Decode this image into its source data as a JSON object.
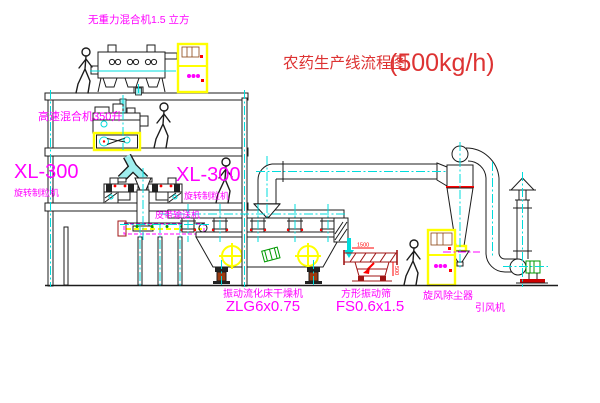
{
  "title": {
    "main": "农药生产线流程图",
    "capacity": "(500kg/h)"
  },
  "labels": {
    "zero_gravity_mixer": "无重力混合机1.5 立方",
    "high_speed_mixer": "高速混合机350升",
    "granulator_left_model": "XL-300",
    "granulator_left_name": "旋转制粒机",
    "granulator_right_model": "XL-300",
    "granulator_right_name": "旋转制粒机",
    "belt_conveyor": "皮带输送机",
    "fluid_bed_dryer_name": "振动流化床干燥机",
    "fluid_bed_dryer_model": "ZLG6x0.75",
    "square_sieve_name": "方形振动筛",
    "square_sieve_model": "FS0.6x1.5",
    "cyclone_collector": "旋风除尘器",
    "induced_draft_fan": "引风机"
  },
  "dimensions": {
    "sieve_length": "1500",
    "sieve_height": "500"
  },
  "colors": {
    "label_magenta": "#ff00ff",
    "title_red": "#dd3333",
    "centerline_cyan": "#00dcdc",
    "highlight_yellow": "#ffff00",
    "accent_red": "#ff0000",
    "motor_green": "#009900"
  }
}
